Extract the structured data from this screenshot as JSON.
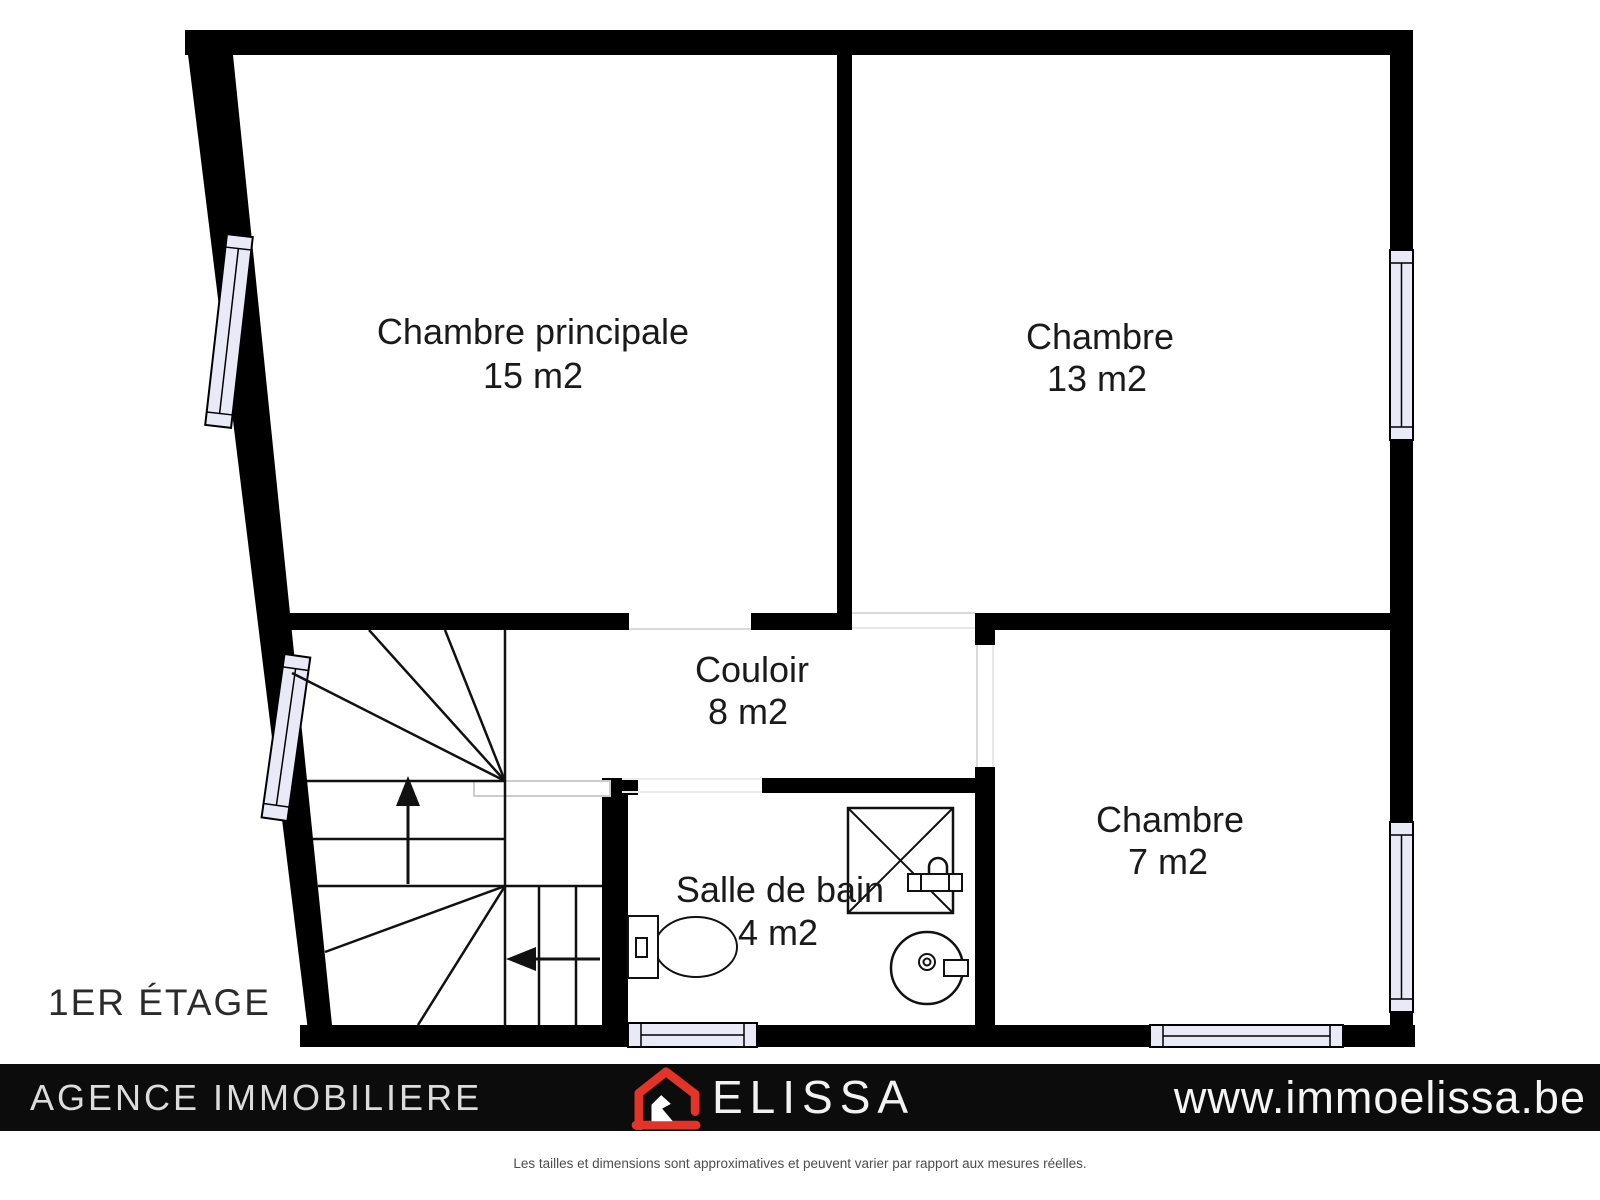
{
  "floor_label": "1ER ÉTAGE",
  "rooms": [
    {
      "name": "Chambre principale",
      "area": "15 m2"
    },
    {
      "name": "Chambre",
      "area": "13 m2"
    },
    {
      "name": "Couloir",
      "area": "8 m2"
    },
    {
      "name": "Salle de bain",
      "area": "4 m2"
    },
    {
      "name": "Chambre",
      "area": "7 m2"
    }
  ],
  "footer": {
    "agency": "AGENCE IMMOBILIERE",
    "brand": "ELISSA",
    "website": "www.immoelissa.be"
  },
  "disclaimer": "Les tailles et dimensions sont approximatives et peuvent varier par rapport aux mesures réelles.",
  "icons": {
    "logo": "red-house-logo",
    "stairs_up": "arrow-up",
    "stairs_down": "arrow-left",
    "fixtures": [
      "shower",
      "toilet",
      "sink"
    ],
    "windows": "double-pane-window"
  },
  "colors": {
    "wall": "#000000",
    "window_fill": "#e9e9f7",
    "opening_line": "#d9d9d9",
    "accent_red": "#e23429",
    "footer_bg": "#0c0c0c",
    "footer_text": "#dcdcdc",
    "label_text": "#1a1a1a"
  }
}
